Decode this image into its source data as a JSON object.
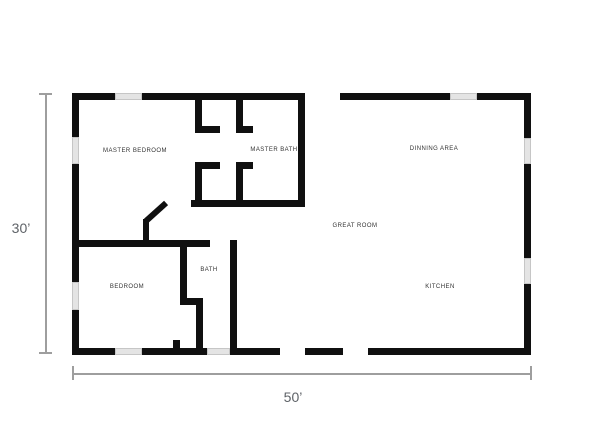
{
  "plan": {
    "title": "floor-plan",
    "colors": {
      "background": "#ffffff",
      "wall": "#101010",
      "window_fill": "#e4e4e4",
      "window_border": "#c6c6c6",
      "dimension_line": "#9e9e9e",
      "dimension_text": "#5f6368",
      "room_text": "#333333"
    },
    "rooms": [
      {
        "name": "master-bedroom",
        "label": "MASTER BEDROOM",
        "x": 135,
        "y": 151
      },
      {
        "name": "master-bath",
        "label": "MASTER BATH",
        "x": 274,
        "y": 150
      },
      {
        "name": "dinning-area",
        "label": "DINNING AREA",
        "x": 434,
        "y": 149
      },
      {
        "name": "great-room",
        "label": "GREAT ROOM",
        "x": 355,
        "y": 226
      },
      {
        "name": "bedroom",
        "label": "BEDROOM",
        "x": 127,
        "y": 287
      },
      {
        "name": "bath",
        "label": "BATH",
        "x": 209,
        "y": 270
      },
      {
        "name": "kitchen",
        "label": "KITCHEN",
        "x": 440,
        "y": 287
      }
    ],
    "walls": [
      {
        "name": "exterior-top-left",
        "x": 72,
        "y": 93,
        "w": 233,
        "h": 7
      },
      {
        "name": "exterior-top-right",
        "x": 340,
        "y": 93,
        "w": 190,
        "h": 7
      },
      {
        "name": "exterior-left",
        "x": 72,
        "y": 93,
        "w": 7,
        "h": 262
      },
      {
        "name": "exterior-right",
        "x": 524,
        "y": 93,
        "w": 7,
        "h": 262
      },
      {
        "name": "exterior-bottom-1",
        "x": 72,
        "y": 348,
        "w": 208,
        "h": 7
      },
      {
        "name": "exterior-bottom-2",
        "x": 305,
        "y": 348,
        "w": 38,
        "h": 7
      },
      {
        "name": "exterior-bottom-3",
        "x": 368,
        "y": 348,
        "w": 163,
        "h": 7
      },
      {
        "name": "closet-upper-left-v",
        "x": 195,
        "y": 100,
        "w": 7,
        "h": 33
      },
      {
        "name": "closet-upper-left-stub",
        "x": 195,
        "y": 126,
        "w": 25,
        "h": 7
      },
      {
        "name": "closet-upper-right-v",
        "x": 236,
        "y": 100,
        "w": 7,
        "h": 33
      },
      {
        "name": "closet-upper-right-stub",
        "x": 236,
        "y": 126,
        "w": 17,
        "h": 7
      },
      {
        "name": "closet-lower-left-stub",
        "x": 195,
        "y": 162,
        "w": 25,
        "h": 7
      },
      {
        "name": "closet-lower-left-v",
        "x": 195,
        "y": 162,
        "w": 7,
        "h": 45
      },
      {
        "name": "closet-lower-right-stub",
        "x": 236,
        "y": 162,
        "w": 17,
        "h": 7
      },
      {
        "name": "closet-lower-right-v",
        "x": 236,
        "y": 162,
        "w": 7,
        "h": 45
      },
      {
        "name": "closet-bottom-h",
        "x": 191,
        "y": 200,
        "w": 114,
        "h": 7
      },
      {
        "name": "master-bath-right-v",
        "x": 298,
        "y": 93,
        "w": 7,
        "h": 114
      },
      {
        "name": "hall-south-h",
        "x": 79,
        "y": 240,
        "w": 131,
        "h": 7
      },
      {
        "name": "bath-right-v",
        "x": 230,
        "y": 240,
        "w": 7,
        "h": 115
      },
      {
        "name": "bedroom-bath-divider-v",
        "x": 180,
        "y": 240,
        "w": 7,
        "h": 65
      },
      {
        "name": "shower-stub-h",
        "x": 180,
        "y": 298,
        "w": 23,
        "h": 7
      },
      {
        "name": "shower-v",
        "x": 196,
        "y": 305,
        "w": 7,
        "h": 43
      },
      {
        "name": "bedroom-door-jamb",
        "x": 173,
        "y": 340,
        "w": 7,
        "h": 15
      }
    ],
    "windows": [
      {
        "name": "window-top-left",
        "x": 115,
        "y": 93,
        "w": 27,
        "h": 7
      },
      {
        "name": "window-top-right",
        "x": 450,
        "y": 93,
        "w": 27,
        "h": 7
      },
      {
        "name": "window-left-upper",
        "x": 72,
        "y": 137,
        "w": 7,
        "h": 27
      },
      {
        "name": "window-left-lower",
        "x": 72,
        "y": 282,
        "w": 7,
        "h": 28
      },
      {
        "name": "window-right-upper",
        "x": 524,
        "y": 138,
        "w": 7,
        "h": 26
      },
      {
        "name": "window-right-lower",
        "x": 524,
        "y": 258,
        "w": 7,
        "h": 26
      },
      {
        "name": "window-bottom-left",
        "x": 115,
        "y": 348,
        "w": 27,
        "h": 7
      },
      {
        "name": "window-bottom-bath",
        "x": 207,
        "y": 348,
        "w": 23,
        "h": 7
      }
    ],
    "door": {
      "leaf": {
        "x": 143,
        "y": 219,
        "w": 6,
        "h": 23
      },
      "swing": {
        "x1": 146,
        "y1": 221,
        "x2": 166,
        "y2": 203,
        "t": 6
      }
    },
    "dimensions": {
      "height_label": "30’",
      "width_label": "50’",
      "vertical_line": {
        "x": 45,
        "y1": 94,
        "y2": 353,
        "thickness": 1.5,
        "cap_len": 13,
        "label_x": 21,
        "label_y": 228
      },
      "horizontal_line": {
        "y": 373,
        "x1": 73,
        "x2": 531,
        "thickness": 1.5,
        "cap_len": 14,
        "label_x": 293,
        "label_y": 397
      }
    }
  }
}
